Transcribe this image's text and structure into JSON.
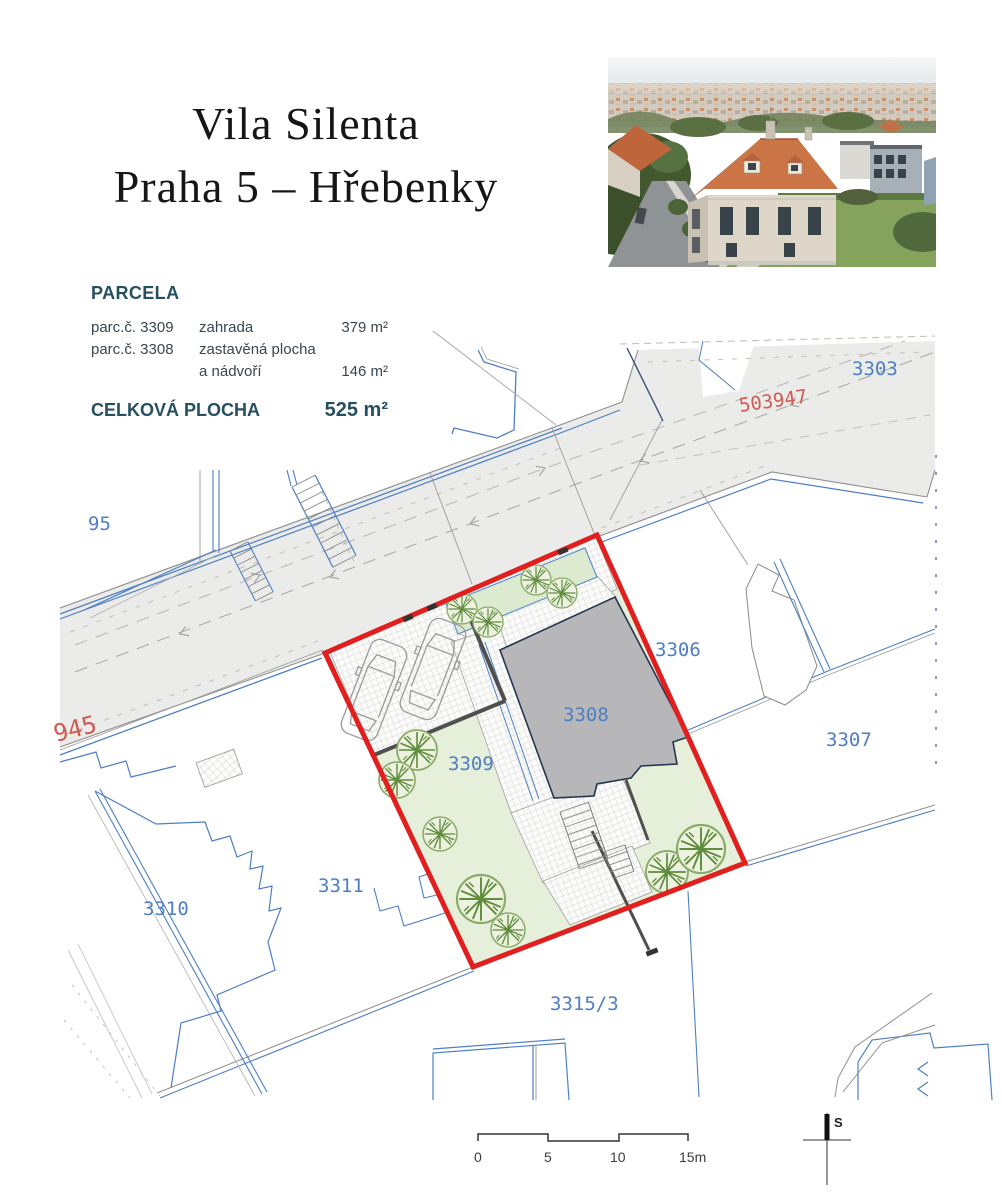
{
  "page": {
    "title_line1": "Vila Silenta",
    "title_line2": "Praha 5 – Hřebenky"
  },
  "parcela": {
    "heading": "PARCELA",
    "rows": [
      {
        "c1": "parc.č. 3309",
        "c2": "zahrada",
        "c3": "379 m²"
      },
      {
        "c1": "parc.č. 3308",
        "c2": "zastavěná plocha",
        "c3": ""
      },
      {
        "c1": "",
        "c2": "a nádvoří",
        "c3": "146 m²"
      }
    ],
    "total_label": "CELKOVÁ PLOCHA",
    "total_value": "525 m²"
  },
  "map": {
    "labels": {
      "p95": "95",
      "p3303": "3303",
      "p3306": "3306",
      "p3307": "3307",
      "p3308": "3308",
      "p3309": "3309",
      "p3310": "3310",
      "p3311": "3311",
      "p3315": "3315/3",
      "road1": "503947",
      "road2": "945"
    },
    "colors": {
      "parcel_number_blue": "#4e7fc2",
      "road_number_red": "#cf5a52",
      "property_outline_red": "#e11f1f",
      "garden_green": "#e6efda",
      "building_gray": "#b7b7ba",
      "road_gray": "#ebebea",
      "boundary_blue": "#4d7fc4"
    }
  },
  "scale_bar": {
    "t0": "0",
    "t5": "5",
    "t10": "10",
    "t15": "15m"
  },
  "north_arrow": {
    "label": "S"
  }
}
